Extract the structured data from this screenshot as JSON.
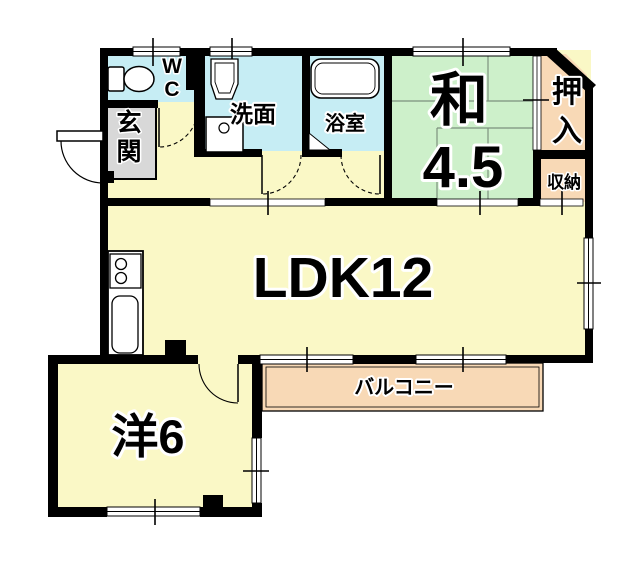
{
  "plan_title": "1LDK apartment floor plan",
  "colors": {
    "wall": "#000000",
    "room_yellow": "#faf8c6",
    "room_cyan": "#c6edf4",
    "room_green": "#cdf0ca",
    "room_peach": "#f8d9b6",
    "genkan_gray": "#d8d8d8",
    "background": "#ffffff"
  },
  "rooms": {
    "wc": {
      "name": "WC",
      "line1": "W",
      "line2": "C"
    },
    "genkan": {
      "name": "玄関",
      "char1": "玄",
      "char2": "関"
    },
    "senmen": {
      "name": "洗面"
    },
    "yokushitsu": {
      "name": "浴室"
    },
    "washitsu": {
      "name": "和4.5",
      "label": "和",
      "size": "4.5"
    },
    "oshiire": {
      "name": "押入",
      "char1": "押",
      "char2": "入"
    },
    "shunou": {
      "name": "収納"
    },
    "ldk": {
      "name": "LDK12"
    },
    "youshitsu": {
      "name": "洋6"
    },
    "balcony": {
      "name": "バルコニー"
    }
  }
}
